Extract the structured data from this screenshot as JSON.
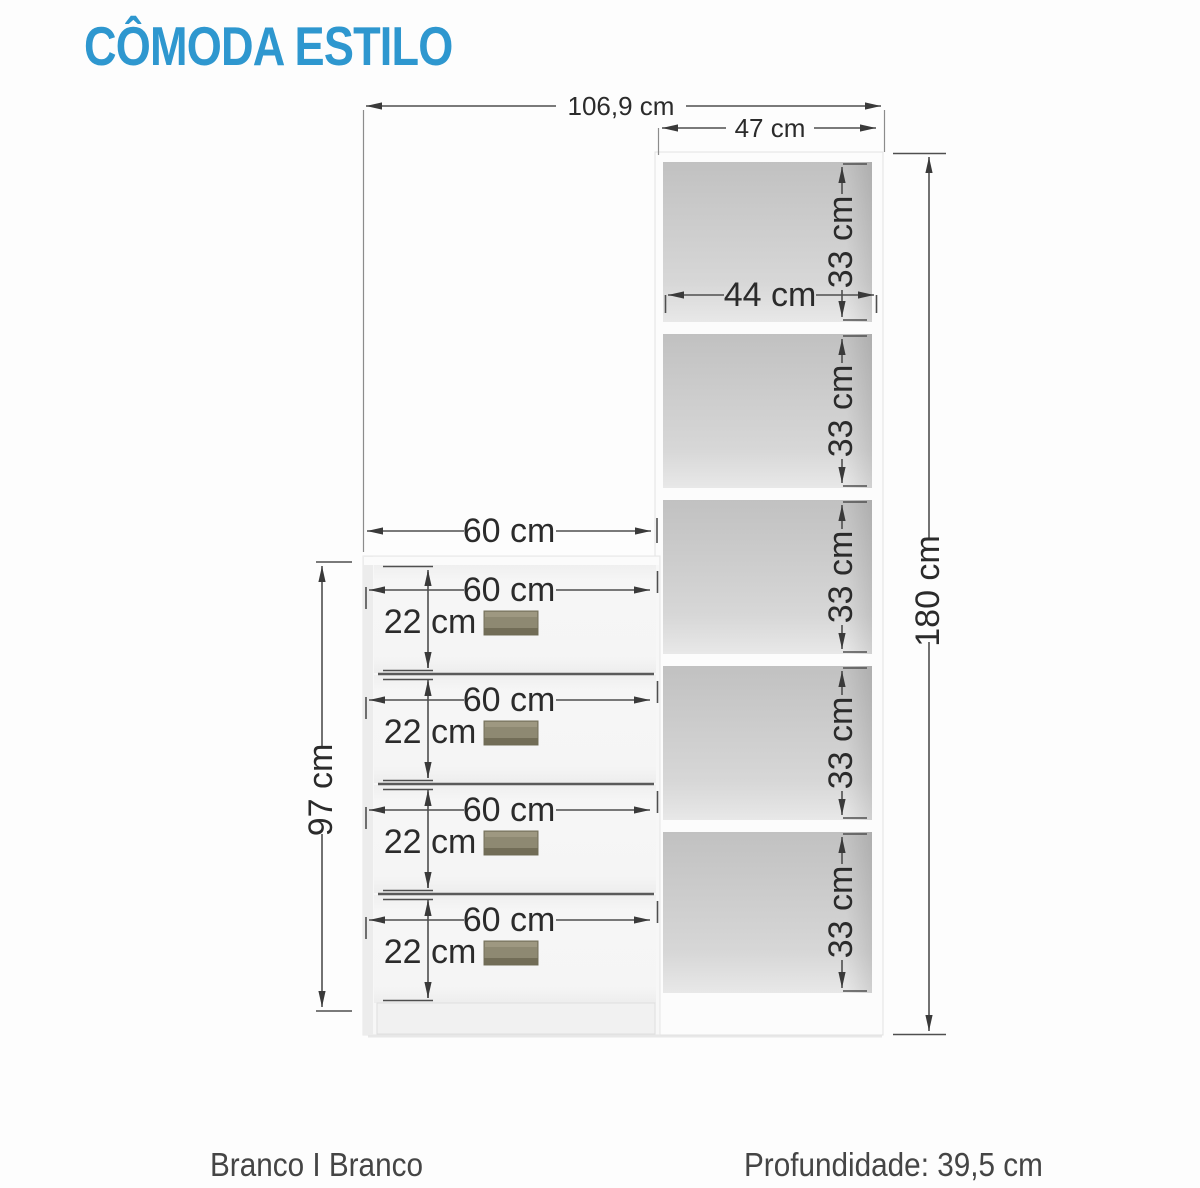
{
  "title": "CÔMODA ESTILO",
  "colors": {
    "accent": "#2e97cf",
    "ink": "#2b2b2b",
    "line": "#4f4f4f",
    "handle": "#8e8972"
  },
  "dimensions": {
    "total_width": "106,9 cm",
    "tower_width": "47 cm",
    "tower_inner_width": "44 cm",
    "tower_height": "180 cm",
    "dresser_width_top": "60 cm",
    "dresser_height": "97 cm",
    "shelves": [
      "33 cm",
      "33 cm",
      "33 cm",
      "33 cm",
      "33 cm"
    ],
    "drawers": [
      {
        "width": "60 cm",
        "height": "22 cm"
      },
      {
        "width": "60 cm",
        "height": "22 cm"
      },
      {
        "width": "60 cm",
        "height": "22 cm"
      },
      {
        "width": "60 cm",
        "height": "22 cm"
      }
    ]
  },
  "footer": {
    "finish": "Branco I Branco",
    "depth": "Profundidade: 39,5 cm"
  }
}
